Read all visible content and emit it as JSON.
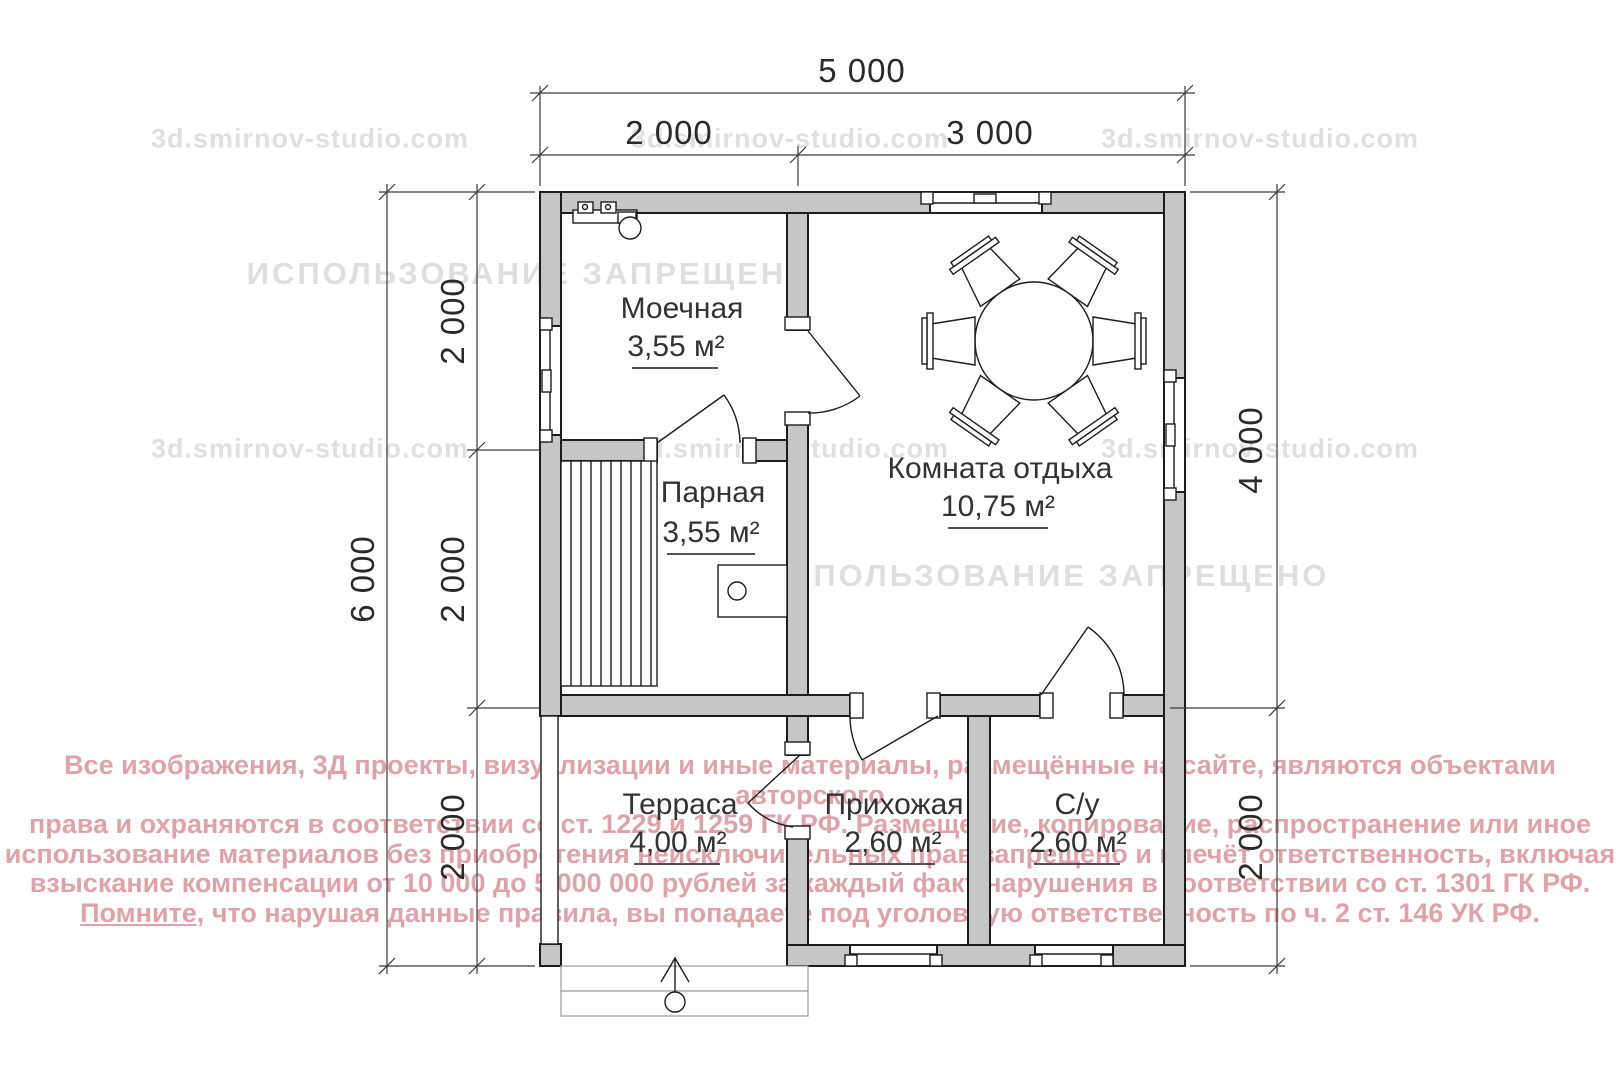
{
  "watermarks": {
    "site": "3d.smirnov-studio.com",
    "forbidden": "ИСПОЛЬЗОВАНИЕ ЗАПРЕЩЕНО"
  },
  "copyright": {
    "line1": "Все изображения, 3Д проекты, визуализации и иные материалы, размещённые на сайте, являются объектами авторского",
    "line2": "права и охраняются в соответствии со ст. 1229 и 1259 ГК РФ. Размещение, копирование, распространение или иное",
    "line3": "использование материалов без приобретения неисключительных прав запрещено и влечёт ответственность, включая",
    "line4": "взыскание компенсации от 10 000 до 5 000 000 рублей за каждый факт нарушения в соответствии со ст. 1301 ГК РФ.",
    "line5_underlined": "Помните,",
    "line5_rest": " что нарушая данные правила, вы попадаете под уголовную ответственность по ч. 2 ст. 146 УК РФ."
  },
  "dimensions": {
    "top_total": "5 000",
    "top_left": "2 000",
    "top_right": "3 000",
    "left_total": "6 000",
    "left_seg1": "2 000",
    "left_seg2": "2 000",
    "left_seg3": "2 000",
    "right_top": "4 000",
    "right_bottom": "2 000"
  },
  "rooms": {
    "washing": {
      "name": "Моечная",
      "area": "3,55 м²"
    },
    "steam": {
      "name": "Парная",
      "area": "3,55 м²"
    },
    "lounge": {
      "name": "Комната отдыха",
      "area": "10,75 м²"
    },
    "terrace": {
      "name": "Терраса",
      "area": "4,00 м²"
    },
    "hallway": {
      "name": "Прихожая",
      "area": "2,60 м²"
    },
    "bathroom": {
      "name": "С/у",
      "area": "2,60 м²"
    }
  },
  "colors": {
    "wall_fill": "#c6c6c6",
    "line_color": "#1c1c1c",
    "copyright_red": "#c55563",
    "watermark_gray": "#969696"
  }
}
